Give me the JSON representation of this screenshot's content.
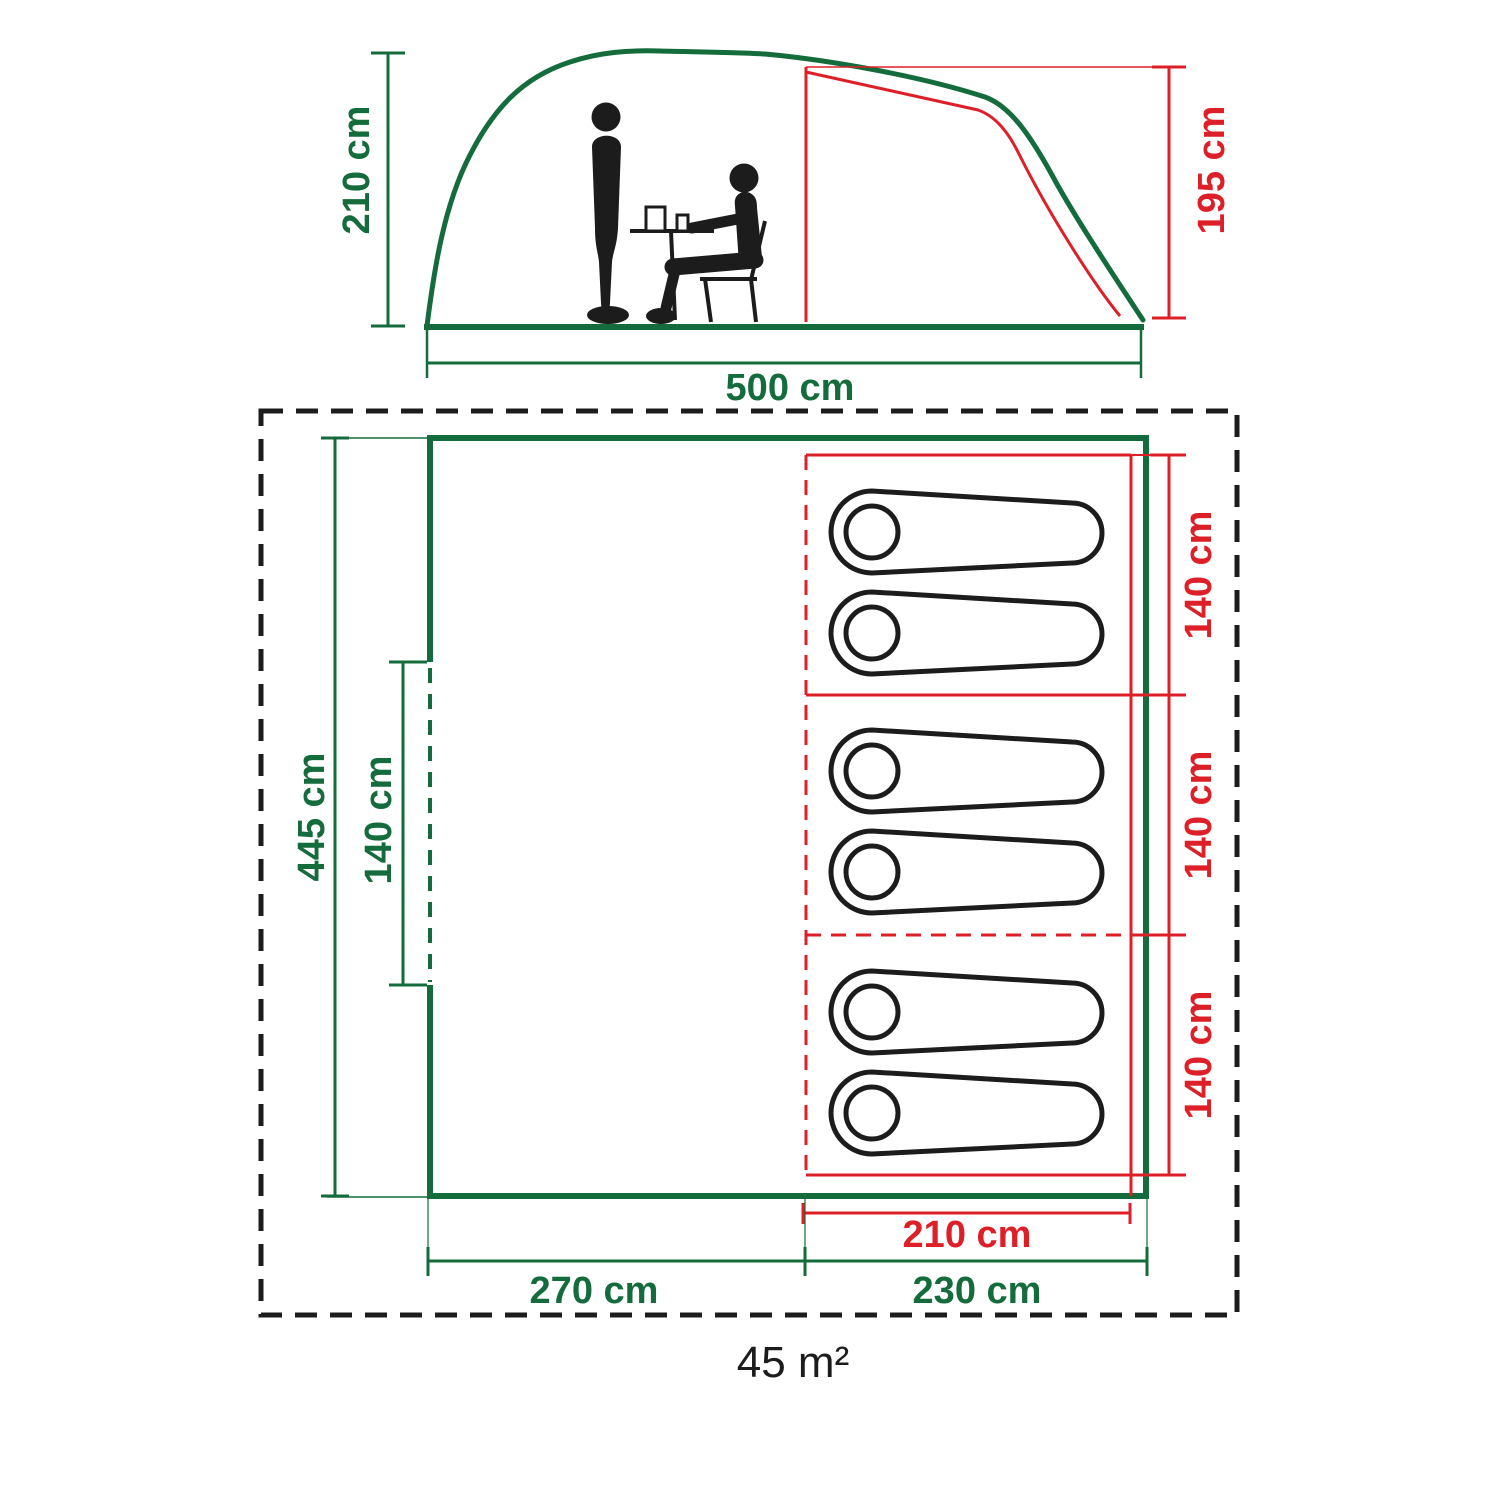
{
  "colors": {
    "outer_tent_green": "#146B3B",
    "inner_tent_red": "#DD2028",
    "line_black": "#1C1C1C"
  },
  "side_view": {
    "outer_height": "210 cm",
    "inner_height": "195 cm",
    "length": "500 cm"
  },
  "floor_plan": {
    "depth": "445 cm",
    "door_width": "140 cm",
    "living_area_width": "270 cm",
    "bedroom_area_width": "230 cm",
    "bedroom_length": "210 cm",
    "bedroom_sections": [
      {
        "width": "140 cm"
      },
      {
        "width": "140 cm"
      },
      {
        "width": "140 cm"
      }
    ],
    "total_area": "45 m²"
  }
}
